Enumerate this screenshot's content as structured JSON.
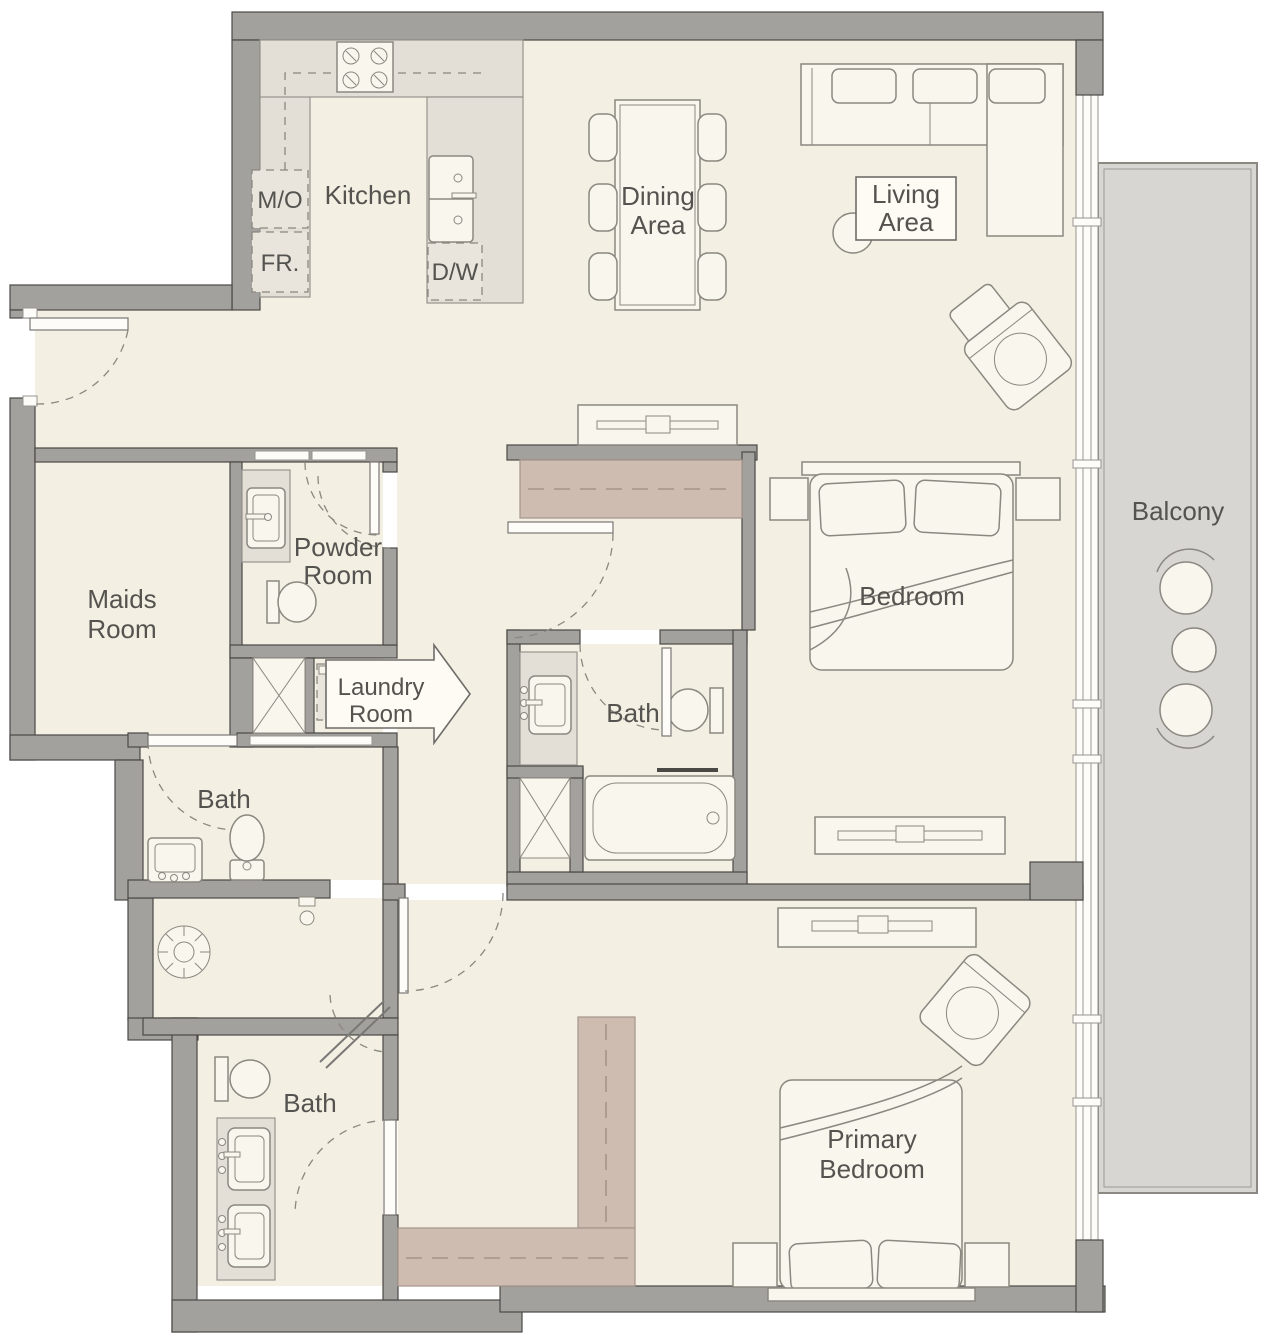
{
  "plan": {
    "rooms": {
      "kitchen": {
        "label": "Kitchen"
      },
      "dining": {
        "line1": "Dining",
        "line2": "Area"
      },
      "living": {
        "line1": "Living",
        "line2": "Area"
      },
      "balcony": {
        "label": "Balcony"
      },
      "maids": {
        "line1": "Maids",
        "line2": "Room"
      },
      "powder": {
        "line1": "Powder",
        "line2": "Room"
      },
      "laundry": {
        "line1": "Laundry",
        "line2": "Room"
      },
      "bath_maids": {
        "label": "Bath"
      },
      "bath_shared": {
        "label": "Bath"
      },
      "bath_primary": {
        "label": "Bath"
      },
      "bedroom": {
        "label": "Bedroom"
      },
      "primary": {
        "line1": "Primary",
        "line2": "Bedroom"
      }
    },
    "appliances": {
      "microwave_oven": "M/O",
      "fridge": "FR.",
      "dishwasher": "D/W"
    },
    "colors": {
      "floor": "#f4efe3",
      "wall": "#a3a19d",
      "counter": "#e3dfd6",
      "wardrobe": "#cfbcb1",
      "balcony": "#d7d6d3",
      "text": "#55534f"
    }
  }
}
